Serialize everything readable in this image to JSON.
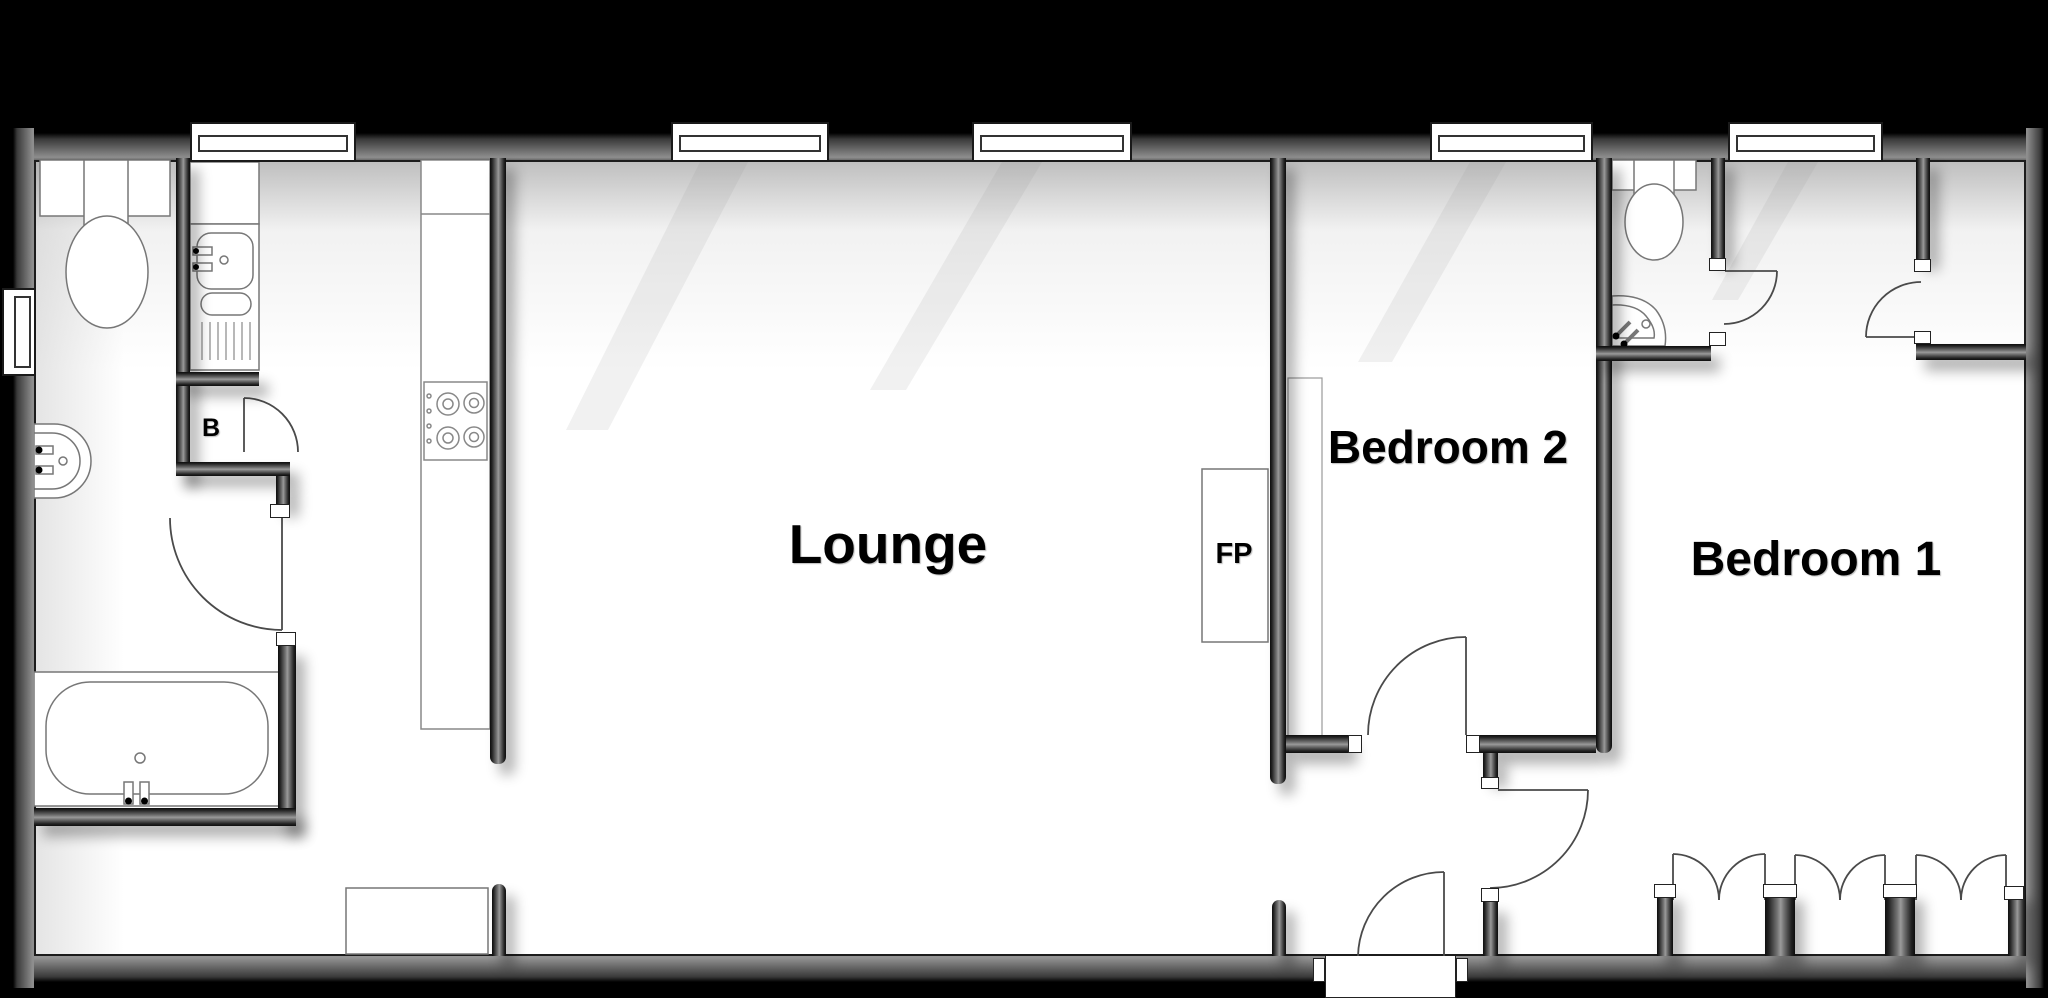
{
  "floorplan": {
    "rooms": {
      "lounge": {
        "label": "Lounge"
      },
      "bedroom2": {
        "label": "Bedroom 2"
      },
      "bedroom1": {
        "label": "Bedroom 1"
      }
    },
    "annotations": {
      "fireplace": {
        "label": "FP"
      },
      "boiler_cupboard": {
        "label": "B"
      }
    },
    "colors": {
      "background": "#000000",
      "wall_mid": "#777777",
      "wall_edge": "#0d0d0d",
      "floor": "#ffffff",
      "fixture_line": "#777777",
      "door_line": "#4a4a4a"
    },
    "features": {
      "windows_top_wall": 5,
      "windows_left_wall": 1,
      "doors": [
        "entrance-door",
        "bathroom-door",
        "boiler-cupboard-door",
        "bedroom2-door",
        "hall-to-bedroom1-door",
        "ensuite-door",
        "store-room-door",
        "wardrobe-double-doors",
        "wardrobe-double-doors",
        "wardrobe-double-doors"
      ],
      "fixtures": [
        "toilet",
        "wash-basin",
        "bath",
        "kitchen-sink-with-drainer",
        "kitchen-counter",
        "hob-4-burner",
        "hall-unit",
        "fireplace",
        "chimney-breast",
        "ensuite-toilet",
        "corner-basin",
        "built-in-wardrobes"
      ]
    }
  }
}
